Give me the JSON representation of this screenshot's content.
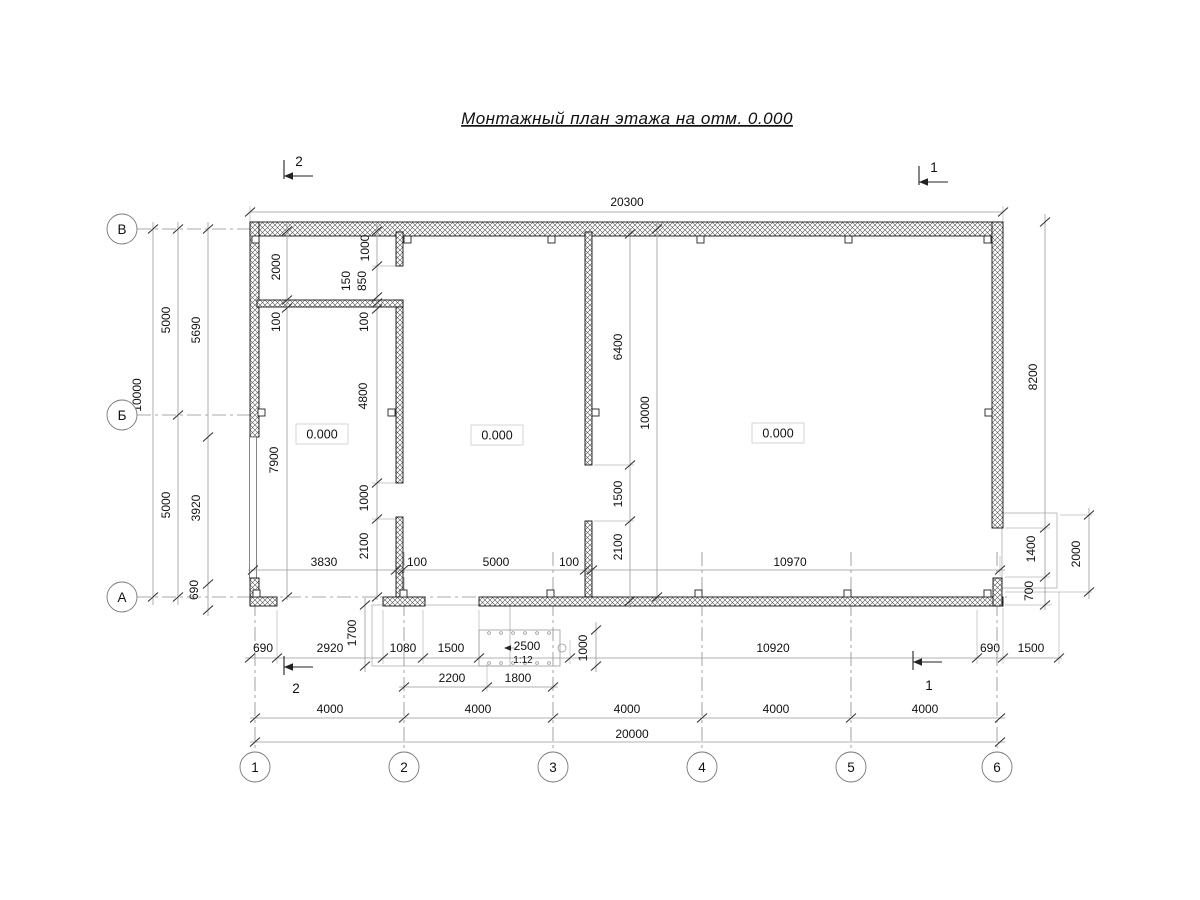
{
  "title": "Монтажный план этажа на отм. 0.000",
  "axes": {
    "cols": [
      "1",
      "2",
      "3",
      "4",
      "5",
      "6"
    ],
    "rows": [
      "В",
      "Б",
      "А"
    ]
  },
  "sections": {
    "top_left": "2",
    "top_right": "1",
    "bottom_left": "2",
    "bottom_right": "1"
  },
  "levels": {
    "left": "0.000",
    "middle": "0.000",
    "right": "0.000"
  },
  "dims": {
    "overall_top": "20300",
    "overall_bottom": "20000",
    "grid": [
      "4000",
      "4000",
      "4000",
      "4000",
      "4000"
    ],
    "left_total": "10000",
    "left_spans": [
      "5000",
      "5000"
    ],
    "left_chain": [
      "5690",
      "3920",
      "690"
    ],
    "room_left": [
      "2000",
      "100",
      "7900"
    ],
    "p1_chain": [
      "1000",
      "850",
      "150",
      "100",
      "4800",
      "1000",
      "2100"
    ],
    "p2_chain": [
      "6400",
      "1500",
      "2100"
    ],
    "mid_total": "10000",
    "right_chain": [
      "8200",
      "1400",
      "700"
    ],
    "right_outer": "2000",
    "widths": [
      "3830",
      "100",
      "5000",
      "100",
      "10970"
    ],
    "bottom_chain": [
      "690",
      "2920",
      "1080",
      "1500",
      "2500"
    ],
    "bottom_right": [
      "10920",
      "690",
      "1500"
    ],
    "porch_depth": "1700",
    "entry": [
      "2200",
      "1800"
    ],
    "ramp": {
      "length": "2500",
      "slope": "1:12",
      "width": "1000"
    }
  }
}
